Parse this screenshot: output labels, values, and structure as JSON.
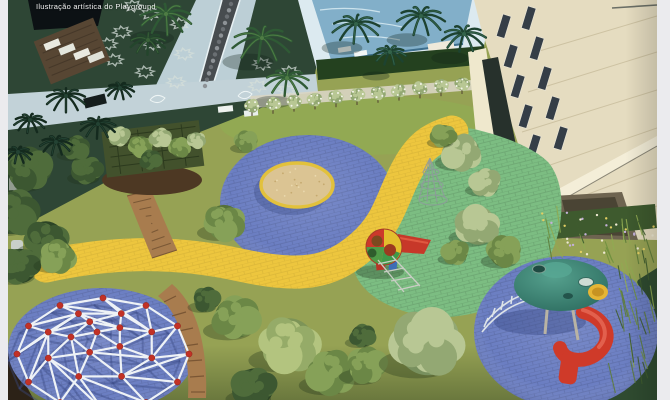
{
  "caption": {
    "text": "Ilustração artística do Playground"
  },
  "colors": {
    "frame": "#ebebee",
    "lawn": "#96a254",
    "shaded_garden": "#2e4635",
    "walkway": "#c2d2d8",
    "pool_water": "#82afc9",
    "building_facade": "#e5dcc0",
    "blue_rubber": "#6b7ec2",
    "green_rubber": "#7cbd82",
    "yellow_path": "#edc63e",
    "sand": "#dbc493",
    "wood": "#a87c4e",
    "caption_text": "#ffffff"
  },
  "scene": {
    "description": "Aerial artistic rendering of a residential condominium playground",
    "elements": [
      "swimming pool deck",
      "apartment building facade",
      "shaded garden with star parterre",
      "water runnel walkway",
      "pergola with vines",
      "wooden plank path",
      "round sand trampoline",
      "yellow winding path",
      "blue rubber circles",
      "green rubber area",
      "geodesic climbing dome",
      "curved wooden bench",
      "ball climber with slide",
      "wire climber",
      "canopy tower with spiral slide",
      "palm trees",
      "shrubs",
      "ornamental grass bed",
      "flowering shrub row"
    ]
  }
}
